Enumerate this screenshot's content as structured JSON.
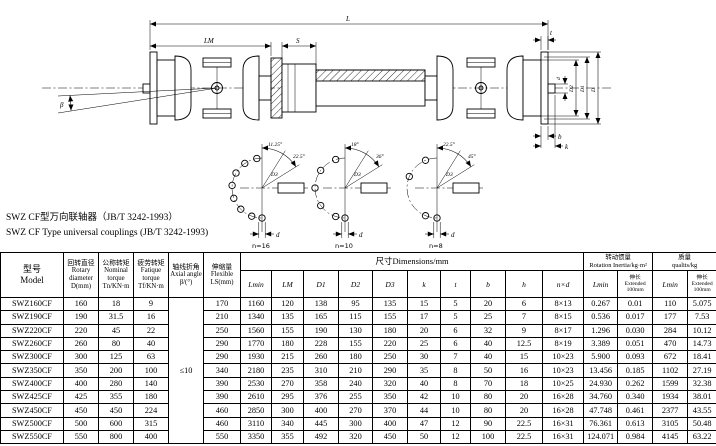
{
  "title": {
    "line1": "SWZ CF型万向联轴器（JB/T 3242-1993）",
    "line2": "SWZ CF Type universal couplings (JB/T 3242-1993)"
  },
  "drawing": {
    "dims": {
      "overall": "L",
      "left_joint": "LM",
      "slide": "S",
      "flange_thickness": "t",
      "pilot_dia": "d",
      "spigot_dia": "D2",
      "bolt_circle_dia": "D1",
      "flange_dia": "D",
      "key_b": "b",
      "key_k": "k",
      "angle": "β"
    },
    "details": [
      {
        "label": "n=16",
        "half_angle": "11.25°",
        "pitch_angle": "22.5°",
        "hole_dia": "d",
        "circle_dia": "D3"
      },
      {
        "label": "n=10",
        "half_angle": "18°",
        "pitch_angle": "36°",
        "hole_dia": "d",
        "circle_dia": "D3"
      },
      {
        "label": "n=8",
        "half_angle": "22.5°",
        "pitch_angle": "45°",
        "hole_dia": "d",
        "circle_dia": "D3"
      }
    ]
  },
  "table": {
    "headers": {
      "col_model": "型号\nModel",
      "col_d": "回转直径\nRotary\ndiameter\nD(mm)",
      "col_tn": "公称转矩\nNominal\ntorque\nTn/KN·m",
      "col_tf": "疲劳转矩\nFatique\ntorque\nTf/KN·m",
      "col_beta": "轴线折角\nAxial angle\nβ/(°)",
      "col_ls": "伸缩量\nFlexible\nLS(mm)",
      "group_dims": "尺寸Dimensions/mm",
      "group_inertia": "转动惯量\nRotation Inertia/kg·m²",
      "group_mass": "质量\nqualits/kg",
      "sub_lmin": "Lmin",
      "sub_extended": "伸长\nExtended\n100mm",
      "dim_cols": [
        "Lmin",
        "LM",
        "D1",
        "D2",
        "D3",
        "k",
        "t",
        "b",
        "h",
        "n×d"
      ]
    },
    "merged": {
      "col": 4,
      "rowspan": 11,
      "value": "≤10"
    },
    "rows": [
      [
        "SWZ160CF",
        "160",
        "18",
        "9",
        "170",
        "1160",
        "120",
        "138",
        "95",
        "135",
        "15",
        "5",
        "20",
        "6",
        "8×13",
        "0.267",
        "0.01",
        "110",
        "5.075"
      ],
      [
        "SWZ190CF",
        "190",
        "31.5",
        "16",
        "210",
        "1340",
        "135",
        "165",
        "115",
        "155",
        "17",
        "5",
        "25",
        "7",
        "8×15",
        "0.536",
        "0.017",
        "177",
        "7.53"
      ],
      [
        "SWZ220CF",
        "220",
        "45",
        "22",
        "250",
        "1560",
        "155",
        "190",
        "130",
        "180",
        "20",
        "6",
        "32",
        "9",
        "8×17",
        "1.296",
        "0.030",
        "284",
        "10.12"
      ],
      [
        "SWZ260CF",
        "260",
        "80",
        "40",
        "290",
        "1770",
        "180",
        "228",
        "155",
        "220",
        "25",
        "6",
        "40",
        "12.5",
        "8×19",
        "3.389",
        "0.051",
        "470",
        "14.73"
      ],
      [
        "SWZ300CF",
        "300",
        "125",
        "63",
        "290",
        "1930",
        "215",
        "260",
        "180",
        "250",
        "30",
        "7",
        "40",
        "15",
        "10×23",
        "5.900",
        "0.093",
        "672",
        "18.41"
      ],
      [
        "SWZ350CF",
        "350",
        "200",
        "100",
        "340",
        "2180",
        "235",
        "310",
        "210",
        "290",
        "35",
        "8",
        "50",
        "16",
        "10×23",
        "13.456",
        "0.185",
        "1102",
        "27.19"
      ],
      [
        "SWZ400CF",
        "400",
        "280",
        "140",
        "390",
        "2530",
        "270",
        "358",
        "240",
        "320",
        "40",
        "8",
        "70",
        "18",
        "10×25",
        "24.930",
        "0.262",
        "1599",
        "32.38"
      ],
      [
        "SWZ425CF",
        "425",
        "355",
        "180",
        "390",
        "2610",
        "295",
        "376",
        "255",
        "350",
        "42",
        "10",
        "80",
        "20",
        "16×28",
        "34.760",
        "0.340",
        "1934",
        "38.01"
      ],
      [
        "SWZ450CF",
        "450",
        "450",
        "224",
        "460",
        "2850",
        "300",
        "400",
        "270",
        "370",
        "44",
        "10",
        "80",
        "20",
        "16×28",
        "47.748",
        "0.461",
        "2377",
        "43.55"
      ],
      [
        "SWZ500CF",
        "500",
        "600",
        "315",
        "460",
        "3110",
        "340",
        "445",
        "300",
        "400",
        "47",
        "12",
        "90",
        "22.5",
        "16×31",
        "76.361",
        "0.613",
        "3105",
        "50.48"
      ],
      [
        "SWZ550CF",
        "550",
        "800",
        "400",
        "550",
        "3350",
        "355",
        "492",
        "320",
        "450",
        "50",
        "12",
        "100",
        "22.5",
        "16×31",
        "124.071",
        "0.984",
        "4145",
        "63.22"
      ]
    ]
  }
}
